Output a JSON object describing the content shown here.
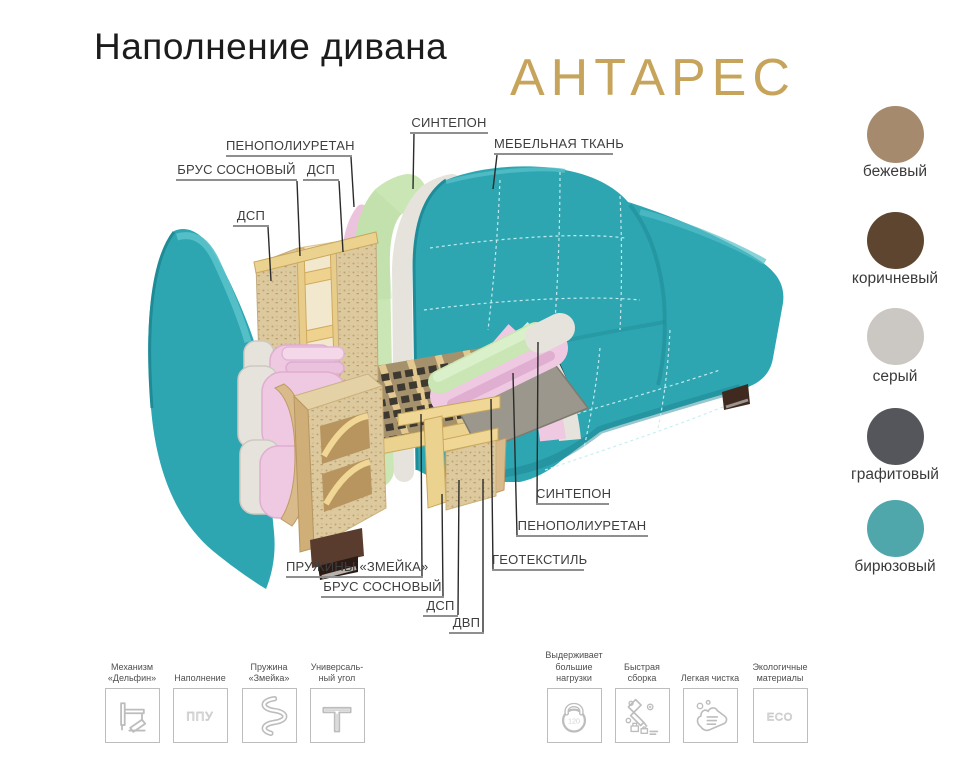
{
  "header": {
    "title": "Наполнение дивана",
    "product_name": "АНТАРЕС"
  },
  "diagram": {
    "labels": [
      {
        "id": "sintepon-top",
        "text": "СИНТЕПОН"
      },
      {
        "id": "mebelnaya-tkan",
        "text": "МЕБЕЛЬНАЯ ТКАНЬ"
      },
      {
        "id": "penopoliuretan-top",
        "text": "ПЕНОПОЛИУРЕТАН"
      },
      {
        "id": "brus-sosnovy-top",
        "text": "БРУС СОСНОВЫЙ"
      },
      {
        "id": "dsp-top",
        "text": "ДСП"
      },
      {
        "id": "dsp-left",
        "text": "ДСП"
      },
      {
        "id": "sintepon-bottom",
        "text": "СИНТЕПОН"
      },
      {
        "id": "penopoliuretan-bottom",
        "text": "ПЕНОПОЛИУРЕТАН"
      },
      {
        "id": "geotextil",
        "text": "ГЕОТЕКСТИЛЬ"
      },
      {
        "id": "pruzhiny-zmeika",
        "text": "ПРУЖИНЫ «ЗМЕЙКА»"
      },
      {
        "id": "brus-sosnovy-bottom",
        "text": "БРУС СОСНОВЫЙ"
      },
      {
        "id": "dsp-bottom",
        "text": "ДСП"
      },
      {
        "id": "dvp",
        "text": "ДВП"
      }
    ]
  },
  "swatches": {
    "items": [
      {
        "name": "бежевый",
        "color": "#a68a6d"
      },
      {
        "name": "коричневый",
        "color": "#5d4530"
      },
      {
        "name": "серый",
        "color": "#cbc7c2"
      },
      {
        "name": "графитовый",
        "color": "#54565b"
      },
      {
        "name": "бирюзовый",
        "color": "#4fa6ab"
      }
    ]
  },
  "features": {
    "items": [
      {
        "label": "Механизм\n«Дельфин»",
        "icon": "dolphin-mechanism"
      },
      {
        "label": "Наполнение",
        "icon": "ppu",
        "icon_text": "ППУ"
      },
      {
        "label": "Пружина\n«Змейка»",
        "icon": "snake-spring"
      },
      {
        "label": "Универсаль-\nный угол",
        "icon": "universal-corner"
      },
      {
        "label": "Выдерживает\nбольшие\nнагрузки",
        "icon": "kettlebell",
        "icon_text": "120"
      },
      {
        "label": "Быстрая\nсборка",
        "icon": "quick-assembly"
      },
      {
        "label": "Легкая чистка",
        "icon": "easy-cleaning"
      },
      {
        "label": "Экологичные\nматериалы",
        "icon": "eco",
        "icon_text": "ECO"
      }
    ]
  },
  "colors": {
    "brand_gold": "#c7a45b",
    "sofa_teal": "#2ea6b1",
    "foam_green": "#c9e6b4",
    "foam_pink": "#eec9e1",
    "sintepon_white": "#e6e3dc",
    "wood": "#ecd28f",
    "chipboard": "#ddc99e",
    "geotextile_gray": "#9b978c"
  }
}
